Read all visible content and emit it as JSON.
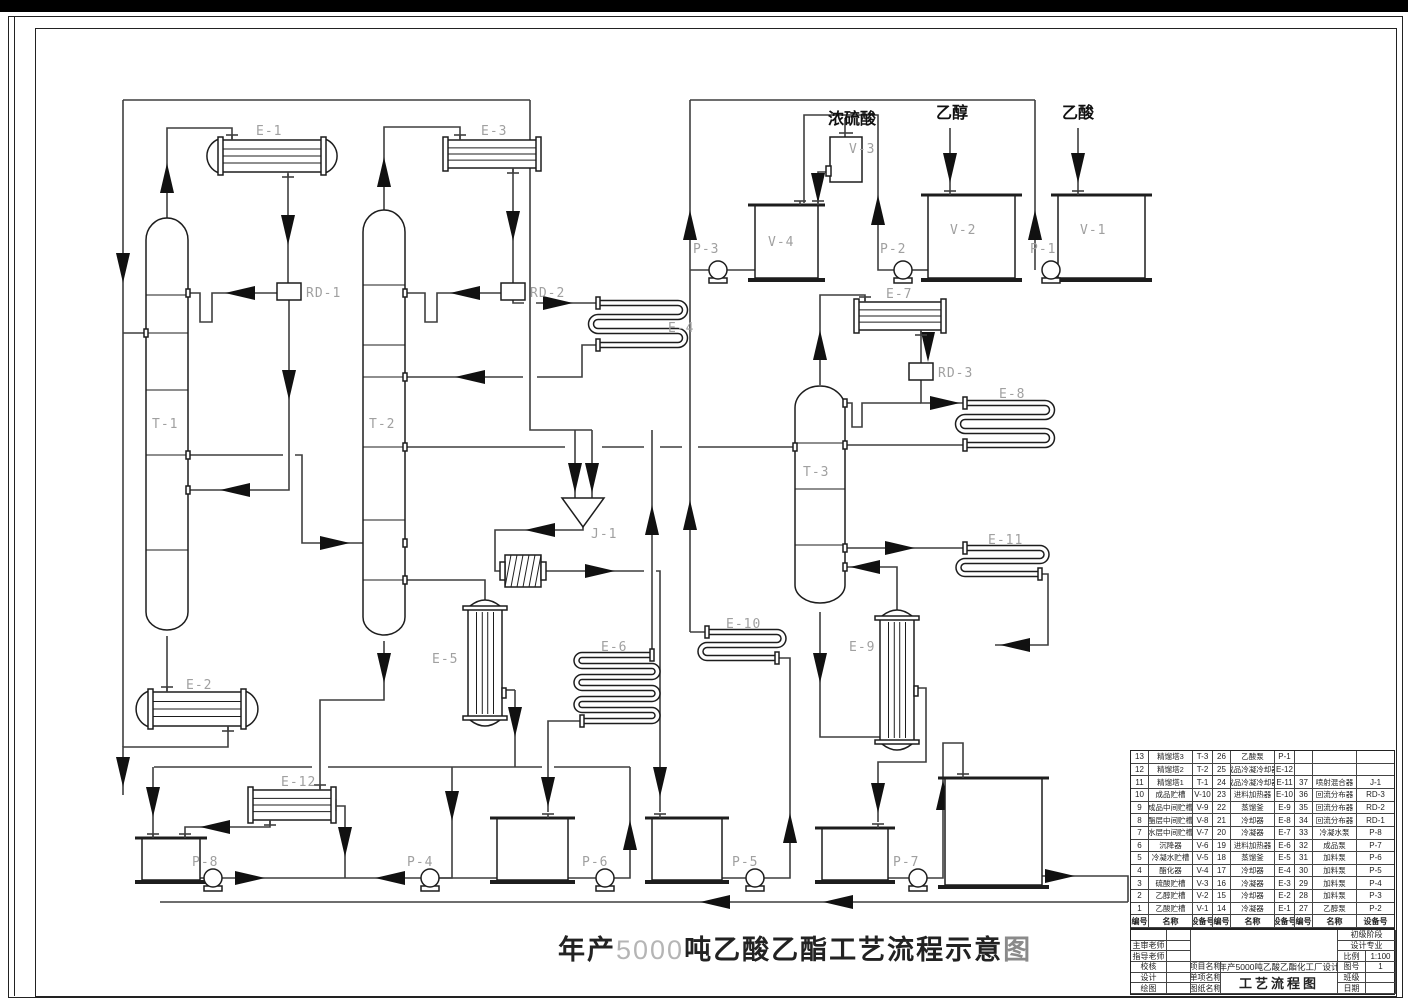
{
  "diagram_title": {
    "prefix": "年产",
    "capacity": "5000",
    "body": "吨乙酸乙酯工艺流程示意",
    "suffix": "图"
  },
  "feed_labels": {
    "sulfuric_acid": "浓硫酸",
    "ethanol": "乙醇",
    "acetic_acid": "乙酸"
  },
  "equipment_labels": {
    "t1": "T-1",
    "t2": "T-2",
    "t3": "T-3",
    "e1": "E-1",
    "e2": "E-2",
    "e3": "E-3",
    "e4": "E-4",
    "e5": "E-5",
    "e6": "E-6",
    "e7": "E-7",
    "e8": "E-8",
    "e9": "E-9",
    "e10": "E-10",
    "e11": "E-11",
    "e12": "E-12",
    "rd1": "RD-1",
    "rd2": "RD-2",
    "rd3": "RD-3",
    "j1": "J-1",
    "p1": "P-1",
    "p2": "P-2",
    "p3": "P-3",
    "p4": "P-4",
    "p5": "P-5",
    "p6": "P-6",
    "p7": "P-7",
    "p8": "P-8",
    "v1": "V-1",
    "v2": "V-2",
    "v3": "V-3",
    "v4": "V-4"
  },
  "equipment_table": {
    "headers": [
      "编号",
      "名称",
      "设备号"
    ],
    "rows": [
      [
        "13",
        "精馏塔3",
        "T-3",
        "26",
        "乙酸泵",
        "P-1",
        "",
        "",
        ""
      ],
      [
        "12",
        "精馏塔2",
        "T-2",
        "25",
        "成品冷凝冷却器",
        "E-12",
        "",
        "",
        ""
      ],
      [
        "11",
        "精馏塔1",
        "T-1",
        "24",
        "成品冷凝冷却器",
        "E-11",
        "37",
        "喷射混合器",
        "J-1"
      ],
      [
        "10",
        "成品贮槽",
        "V-10",
        "23",
        "进料加热器",
        "E-10",
        "36",
        "回流分布器",
        "RD-3"
      ],
      [
        "9",
        "成品中间贮槽",
        "V-9",
        "22",
        "蒸馏釜",
        "E-9",
        "35",
        "回流分布器",
        "RD-2"
      ],
      [
        "8",
        "酯层中间贮槽",
        "V-8",
        "21",
        "冷却器",
        "E-8",
        "34",
        "回流分布器",
        "RD-1"
      ],
      [
        "7",
        "水层中间贮槽",
        "V-7",
        "20",
        "冷凝器",
        "E-7",
        "33",
        "冷凝水泵",
        "P-8"
      ],
      [
        "6",
        "沉降器",
        "V-6",
        "19",
        "进料加热器",
        "E-6",
        "32",
        "成品泵",
        "P-7"
      ],
      [
        "5",
        "冷凝水贮槽",
        "V-5",
        "18",
        "蒸馏釜",
        "E-5",
        "31",
        "加料泵",
        "P-6"
      ],
      [
        "4",
        "酯化器",
        "V-4",
        "17",
        "冷却器",
        "E-4",
        "30",
        "加料泵",
        "P-5"
      ],
      [
        "3",
        "硫酸贮槽",
        "V-3",
        "16",
        "冷凝器",
        "E-3",
        "29",
        "加料泵",
        "P-4"
      ],
      [
        "2",
        "乙醇贮槽",
        "V-2",
        "15",
        "冷却器",
        "E-2",
        "28",
        "加料泵",
        "P-3"
      ],
      [
        "1",
        "乙酸贮槽",
        "V-1",
        "14",
        "冷凝器",
        "E-1",
        "27",
        "乙醇泵",
        "P-2"
      ]
    ]
  },
  "title_block": {
    "stage": "初级阶段",
    "reviewer_label": "主审老师",
    "advisor_label": "指导老师",
    "checker_label": "校核",
    "designer_label": "设计",
    "drafter_label": "绘图",
    "major_label": "设计专业",
    "scale_label": "比例",
    "scale_value": "1:100",
    "project_label": "项目名称",
    "project_value": "年产5000吨乙酸乙酯化工厂设计",
    "item_label": "单项名称",
    "sheet_label": "图纸名称",
    "sheet_value": "工艺流程图",
    "fig_label": "图号",
    "fig_value": "1",
    "class_label": "班级",
    "date_label": "日期"
  }
}
